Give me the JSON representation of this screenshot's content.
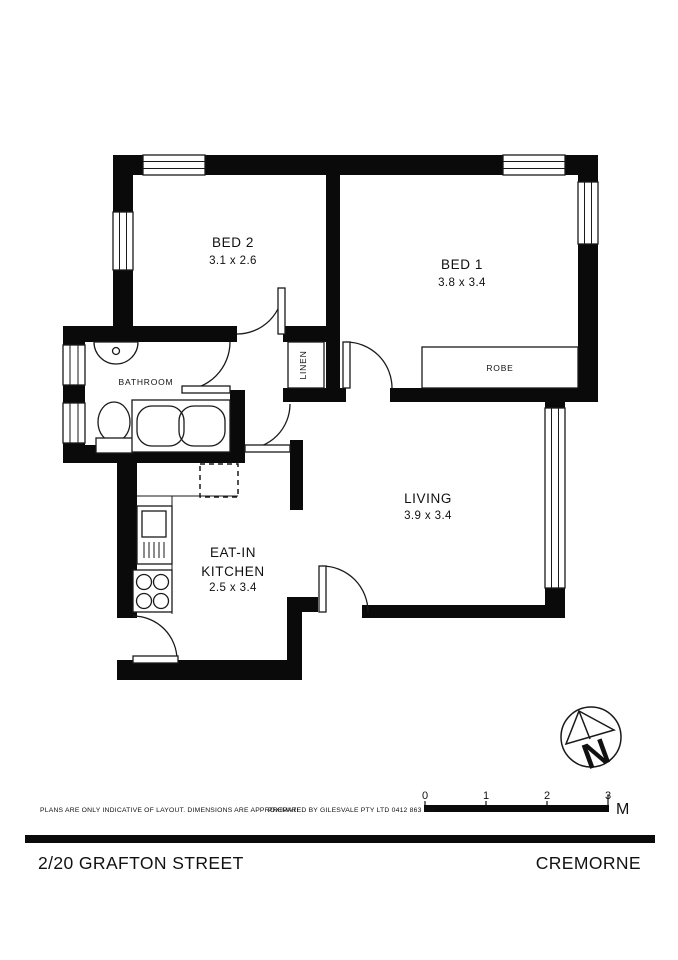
{
  "plan": {
    "rooms": {
      "bed2": {
        "name": "BED 2",
        "dims": "3.1 x 2.6"
      },
      "bed1": {
        "name": "BED 1",
        "dims": "3.8 x 3.4"
      },
      "bathroom": {
        "name": "BATHROOM"
      },
      "kitchen": {
        "name_line1": "EAT-IN",
        "name_line2": "KITCHEN",
        "dims": "2.5 x 3.4"
      },
      "living": {
        "name": "LIVING",
        "dims": "3.9 x 3.4"
      }
    },
    "storage": {
      "linen": "LINEN",
      "robe": "ROBE"
    },
    "compass_letter": "N"
  },
  "scale_bar": {
    "tick0": "0",
    "tick1": "1",
    "tick2": "2",
    "tick3": "3",
    "unit": "M"
  },
  "footer": {
    "disclaimer": "PLANS ARE ONLY INDICATIVE OF LAYOUT. DIMENSIONS ARE APPROXIMATE.",
    "prepared_by": "PREPARED BY GILESVALE PTY LTD  0412 863 888",
    "address": "2/20 GRAFTON STREET",
    "suburb": "CREMORNE"
  },
  "colors": {
    "wall": "#0a0a0a",
    "line": "#1a1a1a",
    "background": "#ffffff"
  }
}
